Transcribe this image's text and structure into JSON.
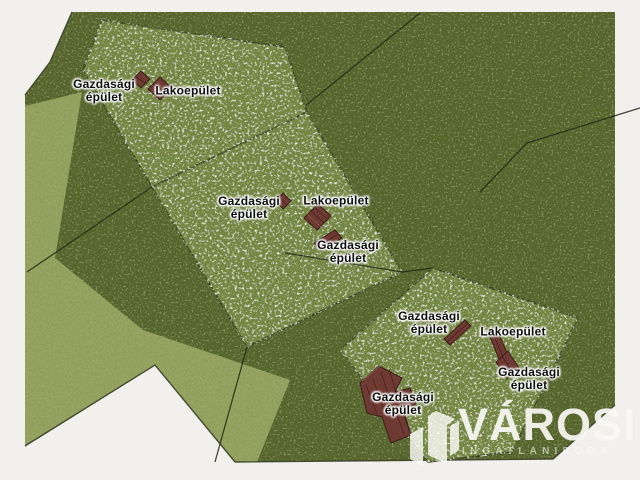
{
  "canvas": {
    "width": 640,
    "height": 480,
    "background": "#f1f0ec"
  },
  "colors": {
    "grass_dark": "#57652f",
    "grass_light": "#8e9c58",
    "parcel_meadow": "#728441",
    "boundary_line": "#222b14",
    "building_roof": "#6e3a33",
    "building_edge": "#3c1e1a",
    "label_text": "#0d0d0d",
    "label_glow": "#ffffff",
    "watermark_white": "#f7f6f2"
  },
  "labels": [
    {
      "name": "farm-building-1",
      "line1": "Gazdasági",
      "line2": "épület"
    },
    {
      "name": "residential-building-1",
      "line1": "Lakoepület",
      "line2": ""
    },
    {
      "name": "farm-building-2",
      "line1": "Gazdasági",
      "line2": "épület"
    },
    {
      "name": "residential-building-2",
      "line1": "Lakoepület",
      "line2": ""
    },
    {
      "name": "farm-building-3",
      "line1": "Gazdasági",
      "line2": "épület"
    },
    {
      "name": "farm-building-4",
      "line1": "Gazdasági",
      "line2": "épület"
    },
    {
      "name": "residential-building-3",
      "line1": "Lakoepület",
      "line2": ""
    },
    {
      "name": "farm-building-5",
      "line1": "Gazdasági",
      "line2": "épület"
    },
    {
      "name": "farm-building-6",
      "line1": "Gazdasági",
      "line2": "épület"
    }
  ],
  "watermark": {
    "brand": "VÁROSI",
    "subtitle": "INGATLANIRODA"
  }
}
